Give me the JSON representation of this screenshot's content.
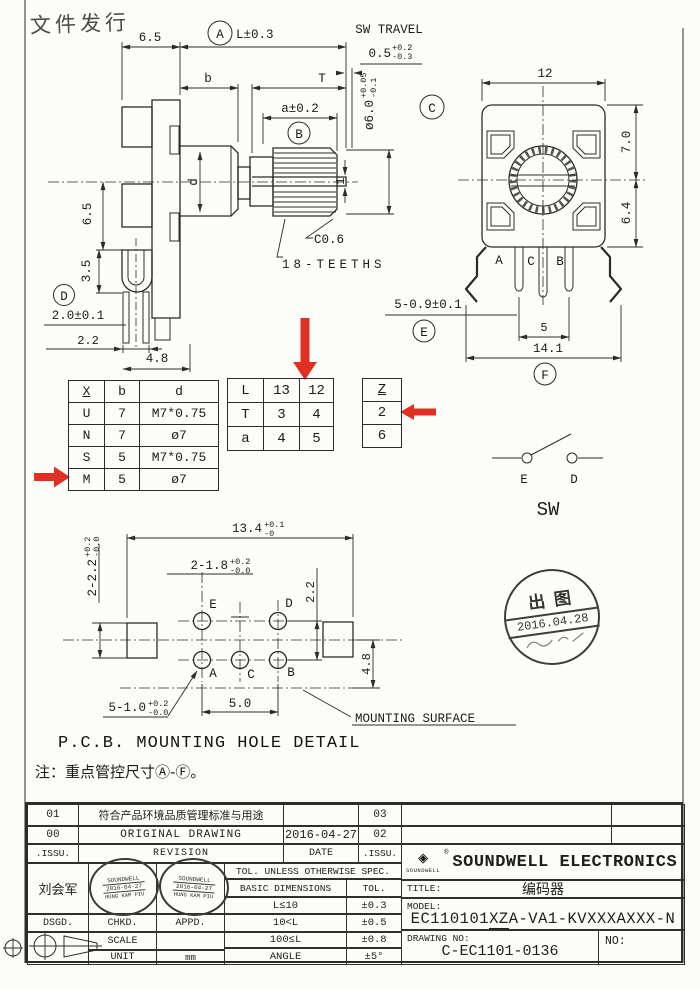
{
  "colors": {
    "ink": "#2b2b2b",
    "red": "#df2418",
    "paper": "#fcfcf8"
  },
  "doc_stamp": "文件发行",
  "side_view": {
    "dim_65_top": "6.5",
    "balloon_a": "A",
    "dim_L": "L±0.3",
    "dim_b": "b",
    "dim_T": "T",
    "dim_a": "a±0.2",
    "balloon_b": "B",
    "sw_travel_label": "SW TRAVEL",
    "sw_travel": {
      "main": "0.5",
      "up": "+0.2",
      "dn": "-0.3"
    },
    "dia": {
      "main": "ø6.0",
      "up": "+0.05",
      "dn": "-0.1"
    },
    "balloon_c": "C",
    "dim_65_left": "6.5",
    "dim_35": "3.5",
    "balloon_d": "D",
    "dim_20": "2.0±0.1",
    "dim_22": "2.2",
    "dim_48": "4.8",
    "dim_d": "d",
    "dim_slot": "1",
    "chamfer": "C0.6",
    "teeth": "18-TEETHS"
  },
  "front_view": {
    "dim_12": "12",
    "dim_70": "7.0",
    "dim_64": "6.4",
    "dim_pins": "5-0.9±0.1",
    "balloon_e": "E",
    "dim_5": "5",
    "dim_141": "14.1",
    "balloon_f": "F",
    "pin_a": "A",
    "pin_c": "C",
    "pin_b": "B"
  },
  "table_xbd": {
    "headers": [
      "X",
      "b",
      "d"
    ],
    "rows": [
      [
        "U",
        "7",
        "M7*0.75"
      ],
      [
        "N",
        "7",
        "ø7"
      ],
      [
        "S",
        "5",
        "M7*0.75"
      ],
      [
        "M",
        "5",
        "ø7"
      ]
    ]
  },
  "table_lta": {
    "rows": [
      [
        "L",
        "13",
        "12"
      ],
      [
        "T",
        "3",
        "4"
      ],
      [
        "a",
        "4",
        "5"
      ]
    ]
  },
  "table_z": {
    "header": "Z",
    "rows": [
      "2",
      "6"
    ]
  },
  "sw": {
    "term_e": "E",
    "term_d": "D",
    "label": "SW"
  },
  "pcb": {
    "title": "P.C.B. MOUNTING HOLE DETAIL",
    "dim_134": {
      "main": "13.4",
      "up": "+0.1",
      "dn": "-0"
    },
    "dim_218": {
      "main": "2-1.8",
      "up": "+0.2",
      "dn": "-0.0"
    },
    "dim_222s": {
      "main": "2-2.2",
      "up": "+0.2",
      "dn": "-0.0"
    },
    "dim_22": "2.2",
    "dim_48": "4.8",
    "dim_50": "5.0",
    "dim_510": {
      "main": "5-1.0",
      "up": "+0.2",
      "dn": "-0.0"
    },
    "mounting": "MOUNTING SURFACE",
    "holes": {
      "e": "E",
      "d": "D",
      "a": "A",
      "c": "C",
      "b": "B"
    }
  },
  "note": "注：重点管控尺寸Ⓐ-Ⓕ。",
  "round_stamp": {
    "top": "出图",
    "date": "2016.04.28"
  },
  "revision": {
    "r1": {
      "issu": "01",
      "text": "符合产品环境品质管理标准与用途",
      "date": "",
      "issu2": "03"
    },
    "r2": {
      "issu": "00",
      "text": "ORIGINAL DRAWING",
      "date": "2016-04-27",
      "issu2": "02"
    },
    "hdr": {
      "issu": ".ISSU.",
      "text": "REVISION",
      "date": "DATE",
      "issu2": ".ISSU."
    }
  },
  "sign": {
    "name": "刘会军",
    "dsgd": "DSGD.",
    "chkd": "CHKD.",
    "appd": "APPD.",
    "scale_label": "SCALE",
    "scale": "",
    "unit_label": "UNIT",
    "unit": "mm"
  },
  "oval_stamp": {
    "line1": "SOUNDWELL",
    "line2": "2016-04-27",
    "line3": "HUNG KAM PIU"
  },
  "tol": {
    "header": "TOL. UNLESS OTHERWISE SPEC.",
    "col1": "BASIC DIMENSIONS",
    "col2": "TOL.",
    "rows": [
      [
        "L≤10",
        "±0.3"
      ],
      [
        "10<L",
        "±0.5"
      ],
      [
        "100≤L",
        "±0.8"
      ],
      [
        "ANGLE",
        "±5°"
      ]
    ]
  },
  "company": {
    "logo_glyph": "◈",
    "logo_text": "SOUNDWELL",
    "reg": "®",
    "name": "SOUNDWELL ELECTRONICS",
    "title_label": "TITLE:",
    "title": "编码器",
    "model_label": "MODEL:",
    "model_pre": "EC110101",
    "model_ul": "XZ",
    "model_post": "A-VA1-KVXXXAXXX-N",
    "drawing_label": "DRAWING NO:",
    "drawing_no": "C-EC1101-0136",
    "no_label": "NO:"
  }
}
